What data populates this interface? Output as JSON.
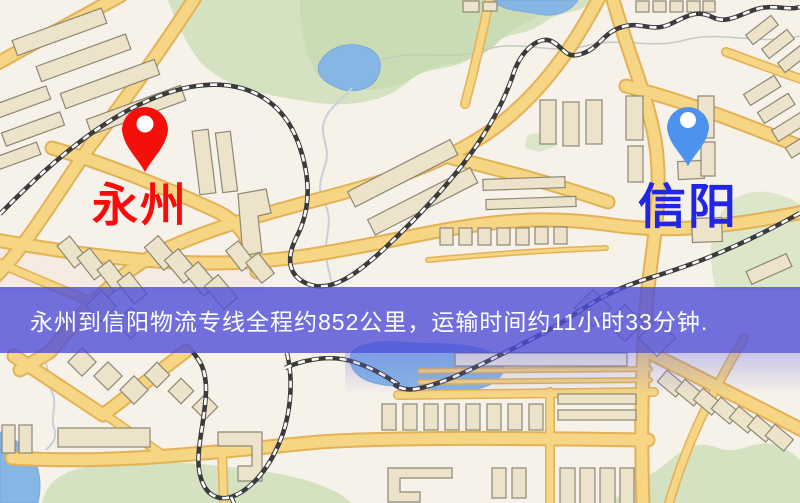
{
  "route_banner": {
    "text": "永州到信阳物流专线全程约852公里，运输时间约11小时33分钟.",
    "origin": "永州",
    "destination": "信阳",
    "distance": "约852公里",
    "duration": "约11小时33分钟"
  },
  "markers": [
    {
      "name": "origin",
      "label": "永州",
      "pin_icon": "red-map-pin"
    },
    {
      "name": "destination",
      "label": "信阳",
      "pin_icon": "blue-map-pin"
    }
  ],
  "theme": {
    "map_bg": "#F7F2E9",
    "road_fill": "#F6D584",
    "road_casing": "#E3B156",
    "building_fill": "#EDE3CA",
    "building_stroke": "#8D8775",
    "park_green": "#D4E2C2",
    "water_blue": "#86B6E4",
    "railway": "#3B3B3B",
    "banner_bg": "rgba(77,78,216,0.80)",
    "banner_text": "#FFFFFF",
    "origin_pin": "#F3100A",
    "origin_label": "#FA0A0A",
    "dest_pin": "#4D92EC",
    "dest_label": "#2025E6"
  }
}
